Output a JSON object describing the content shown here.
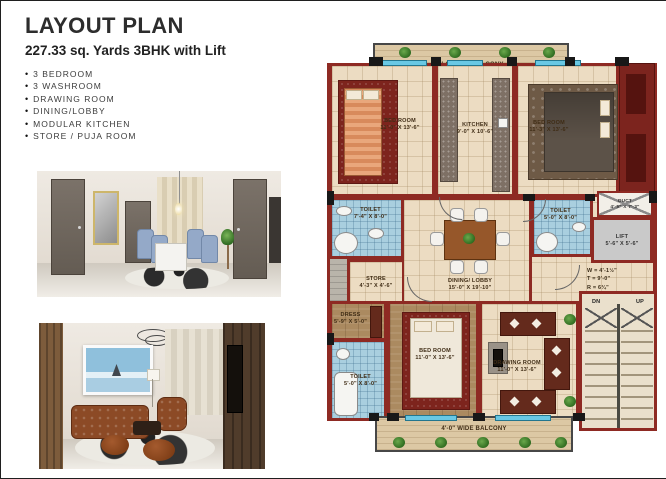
{
  "header": {
    "title": "LAYOUT PLAN",
    "subtitle": "227.33 sq. Yards 3BHK with Lift",
    "features": [
      "3 BEDROOM",
      "3 WASHROOM",
      "DRAWING ROOM",
      "DINING/LOBBY",
      "MODULAR KITCHEN",
      "STORE / PUJA ROOM"
    ]
  },
  "floorplan": {
    "balcony_top": "4'-0\" WIDE BALCONY",
    "balcony_bottom": "4'-0\" WIDE BALCONY",
    "bedroom_top_left": {
      "name": "BED ROOM",
      "size": "11'-0\" X 13'-6\""
    },
    "kitchen": {
      "name": "KITCHEN",
      "size": "9'-0\" X 10'-6\""
    },
    "bedroom_top_right": {
      "name": "BED ROOM",
      "size": "11'-3\" X 13'-6\""
    },
    "toilet_left": {
      "name": "TOILET",
      "size": "7'-4\" X 8'-0\""
    },
    "store": {
      "name": "STORE",
      "size": "4'-3\" X 4'-6\""
    },
    "dining_lobby": {
      "name": "DINING/ LOBBY",
      "size": "15'-0\" X 19'-10\""
    },
    "toilet_right": {
      "name": "TOILET",
      "size": "5'-0\" X 8'-0\""
    },
    "duct": {
      "name": "DUCT",
      "size": "4'-9\" X 7'-3\""
    },
    "lift": {
      "name": "LIFT",
      "size": "5'-6\" X 5'-6\""
    },
    "stair_specs": [
      "W = 4'-1½\"",
      "T = 9'-0\"",
      "R = 6¾\""
    ],
    "dress": {
      "name": "DRESS",
      "size": "5'-9\" X 5'-0\""
    },
    "toilet_bottom": {
      "name": "TOILET",
      "size": "5'-0\" X 8'-0\""
    },
    "bedroom_bottom": {
      "name": "BED ROOM",
      "size": "11'-0\" X 13'-6\""
    },
    "drawing_room": {
      "name": "DRAWING ROOM",
      "size": "11'-0\" X 13'-6\""
    },
    "stairs": {
      "down": "DN",
      "up": "UP"
    }
  },
  "colors": {
    "wall": "#8e2a23",
    "floor_tile": "#ecdcc2",
    "wood_floor": "#ab8a60",
    "toilet_tile": "#a9cfdf",
    "window": "#69c8e4",
    "lift": "#c9c9c9",
    "plant_green": "#3e7b2f",
    "title_text": "#2d2d2d"
  }
}
